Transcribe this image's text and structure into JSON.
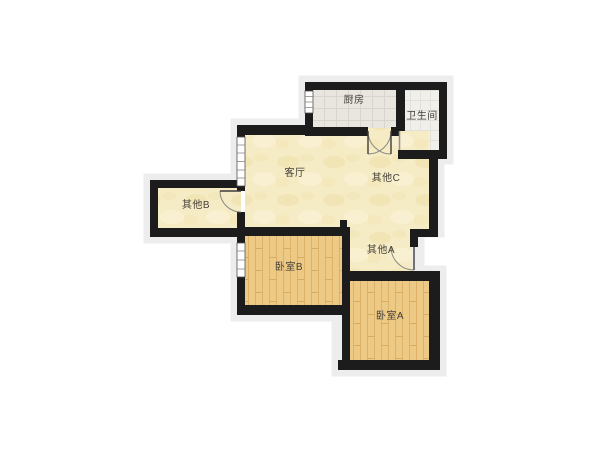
{
  "title": "floor-plan",
  "rooms": {
    "kitchen": {
      "label": "厨房"
    },
    "bathroom": {
      "label": "卫生间"
    },
    "living": {
      "label": "客厅"
    },
    "other_c": {
      "label": "其他C"
    },
    "other_b": {
      "label": "其他B"
    },
    "other_a": {
      "label": "其他A"
    },
    "bedroom_b": {
      "label": "卧室B"
    },
    "bedroom_a": {
      "label": "卧室A"
    }
  },
  "colors": {
    "wall": "#1c1c1c",
    "cream_floor": "#f5ebc5",
    "wood_floor": "#ecca85",
    "kitchen_tile": "#e9e6df",
    "bath_tile": "#f0efea",
    "halo": "#ededed",
    "label_text": "#45413a",
    "door_arc": "#8a8a82"
  }
}
